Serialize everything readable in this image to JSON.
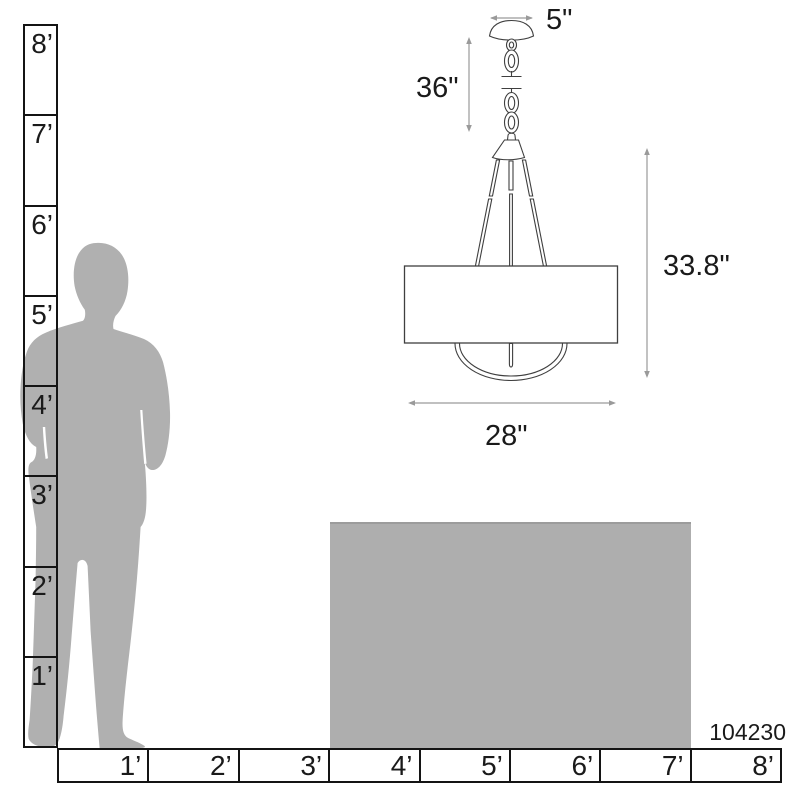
{
  "diagram": {
    "product_number": "104230",
    "fixture_dimensions": {
      "canopy_width": "5\"",
      "chain_length": "36\"",
      "body_height": "33.8\"",
      "body_width": "28\""
    },
    "rulers": {
      "vertical_labels": [
        "8’",
        "7’",
        "6’",
        "5’",
        "4’",
        "3’",
        "2’",
        "1’"
      ],
      "horizontal_labels": [
        "1’",
        "2’",
        "3’",
        "4’",
        "5’",
        "6’",
        "7’",
        "8’"
      ]
    },
    "colors": {
      "silhouette_gray": "#b0b0b0",
      "table_gray": "#aeaeae",
      "fixture_outline": "#3f3f3f",
      "dimension_arrow_gray": "#9a9a9a",
      "ruler_border": "#141414"
    }
  }
}
